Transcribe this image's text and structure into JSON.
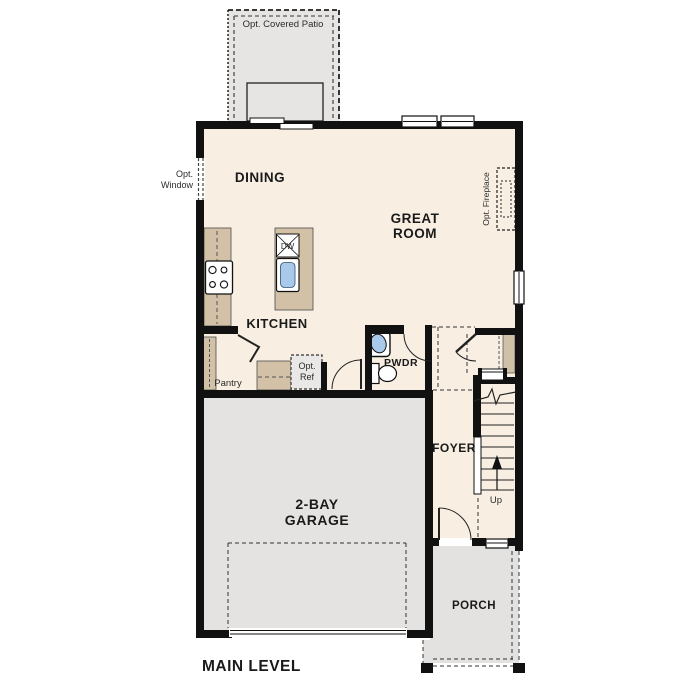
{
  "plan": {
    "title": "MAIN LEVEL",
    "rooms": {
      "dining": "DINING",
      "great_room": [
        "GREAT",
        "ROOM"
      ],
      "kitchen": "KITCHEN",
      "pwdr": "PWDR",
      "foyer": "FOYER",
      "garage": [
        "2-BAY",
        "GARAGE"
      ],
      "porch": "PORCH"
    },
    "annotations": {
      "covered_patio": "Opt. Covered Patio",
      "opt_window": [
        "Opt.",
        "Window"
      ],
      "opt_fireplace": "Opt. Fireplace",
      "pantry": "Pantry",
      "opt_ref": [
        "Opt.",
        "Ref"
      ],
      "dishwasher": "DW",
      "stairs_up": "Up"
    },
    "colors": {
      "wall": "#111111",
      "interior": "#f8efe2",
      "garage": "#e4e3e1",
      "patio": "#e6e5e3",
      "porch": "#e3e2e0",
      "counter": "#d2c1a6",
      "sink_blue": "#a9c9ea",
      "optional_item_fill": "#e9e8e6"
    }
  }
}
